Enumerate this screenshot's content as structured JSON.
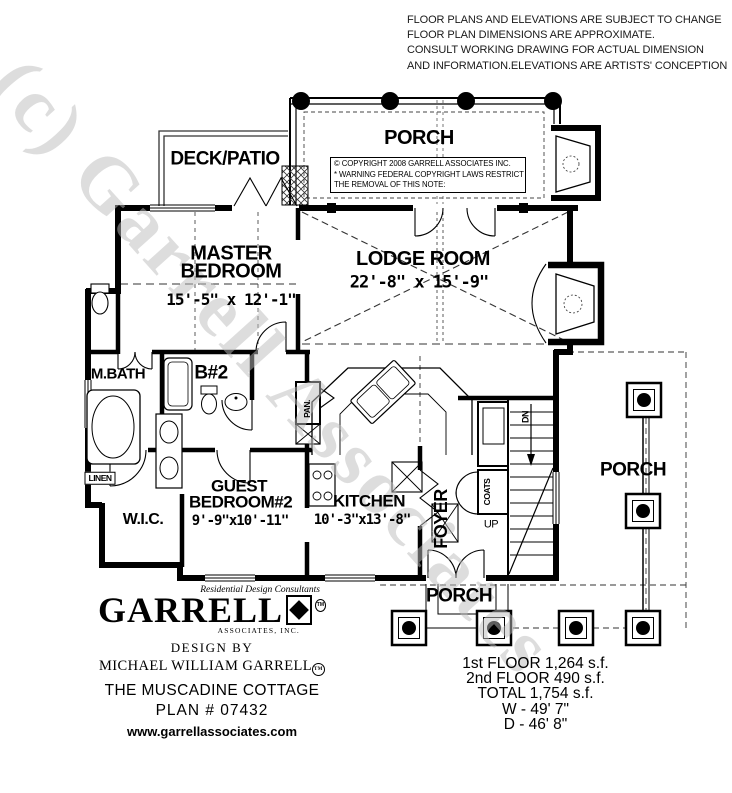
{
  "disclaimer": {
    "lines": [
      "FLOOR PLANS AND ELEVATIONS ARE SUBJECT TO CHANGE",
      "FLOOR PLAN DIMENSIONS ARE APPROXIMATE.",
      "CONSULT WORKING DRAWING FOR ACTUAL DIMENSION",
      "AND INFORMATION.ELEVATIONS ARE ARTISTS' CONCEPTION"
    ]
  },
  "watermark": "(c) Garrell Associates",
  "plan": {
    "copyright": {
      "line1": "© COPYRIGHT 2008 GARRELL ASSOCIATES INC.",
      "line2": "* WARNING FEDERAL COPYRIGHT LAWS RESTRICT",
      "line3": "THE REMOVAL OF THIS NOTE:"
    },
    "rooms": {
      "porch_top": "PORCH",
      "deck_patio": "DECK/PATIO",
      "master_name": "MASTER BEDROOM",
      "master_dims": "15'-5\" x 12'-1\"",
      "lodge_name": "LODGE ROOM",
      "lodge_dims": "22'-8\" x 15'-9\"",
      "m_bath": "M.BATH",
      "bath2": "B#2",
      "linen": "LINEN",
      "wic": "W.I.C.",
      "guest_name": "GUEST BEDROOM#2",
      "guest_dims": "9'-9\"x10'-11\"",
      "kitchen_name": "KITCHEN",
      "kitchen_dims": "10'-3\"x13'-8\"",
      "pantry": "PAN.",
      "foyer": "FOYER",
      "coats": "COATS",
      "stairs_dn": "DN",
      "stairs_up": "UP",
      "porch_right": "PORCH",
      "porch_bottom": "PORCH"
    }
  },
  "logo": {
    "tagline": "Residential Design Consultants",
    "brand": "GARRELL",
    "brand_tm": "TM",
    "associates": "ASSOCIATES, INC.",
    "design_by": "DESIGN BY",
    "designer": "MICHAEL WILLIAM GARRELL",
    "designer_tm": "TM",
    "plan_name": "THE MUSCADINE COTTAGE",
    "plan_number": "PLAN # 07432",
    "website": "www.garrellassociates.com"
  },
  "stats": {
    "lines": [
      "1st FLOOR  1,264 s.f.",
      "2nd FLOOR  490 s.f.",
      "TOTAL  1,754 s.f.",
      "W - 49'  7\"",
      "D - 46'  8\""
    ]
  }
}
